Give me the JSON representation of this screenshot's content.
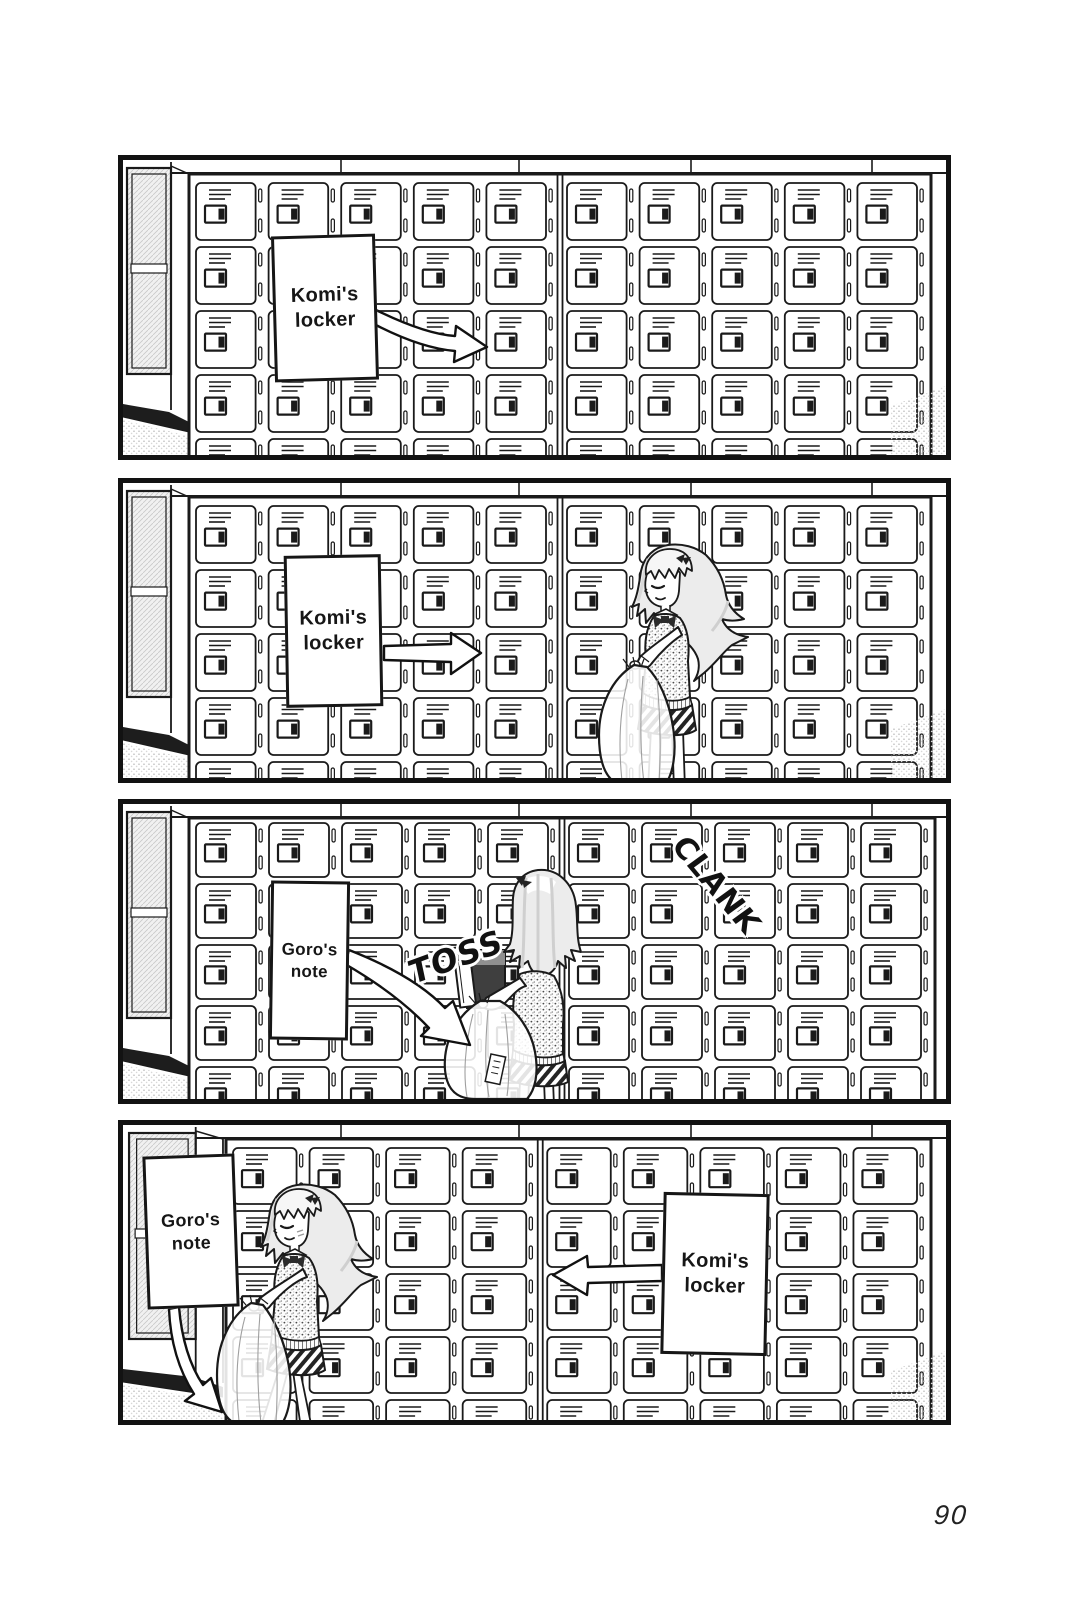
{
  "page": {
    "number": "90"
  },
  "colors": {
    "ink": "#1a1a1a",
    "paper": "#ffffff",
    "hair_tone": "#ececec",
    "locker_interior": "#3f3f3f"
  },
  "panels": {
    "p1": {
      "caption": "Komi's locker",
      "lockers": {
        "columns": 10,
        "rows": 5
      }
    },
    "p2": {
      "caption": "Komi's locker",
      "lockers": {
        "columns": 10,
        "rows": 5
      }
    },
    "p3": {
      "caption": "Goro's note",
      "sfx": {
        "toss": "TOSS",
        "clank": "CLANK"
      },
      "lockers": {
        "columns": 10,
        "rows": 5
      }
    },
    "p4": {
      "caption_left": "Goro's note",
      "caption_right": "Komi's locker",
      "lockers": {
        "columns": 9,
        "rows": 5
      }
    }
  }
}
